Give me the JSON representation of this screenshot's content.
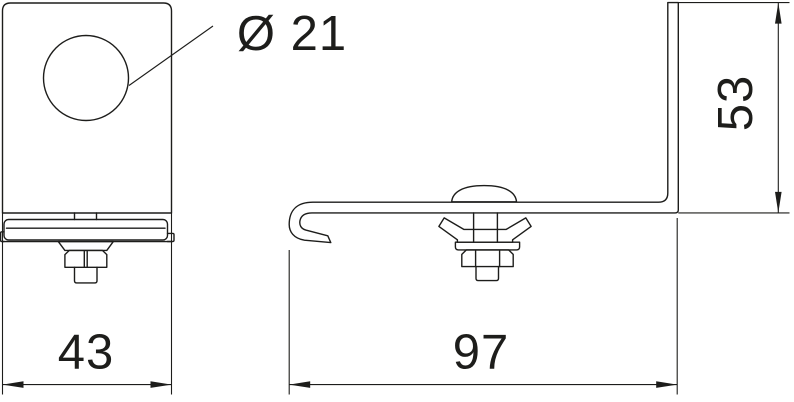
{
  "drawing_type": "technical-dimension-drawing",
  "colors": {
    "line": "#1d1d1b",
    "background": "#ffffff"
  },
  "labels": {
    "hole_diameter": "Ø 21",
    "front_width": "43",
    "side_length": "97",
    "side_height": "53"
  },
  "dimensions": {
    "hole_diameter_value": 21,
    "front_width_value": 43,
    "side_length_value": 97,
    "side_height_value": 53
  }
}
